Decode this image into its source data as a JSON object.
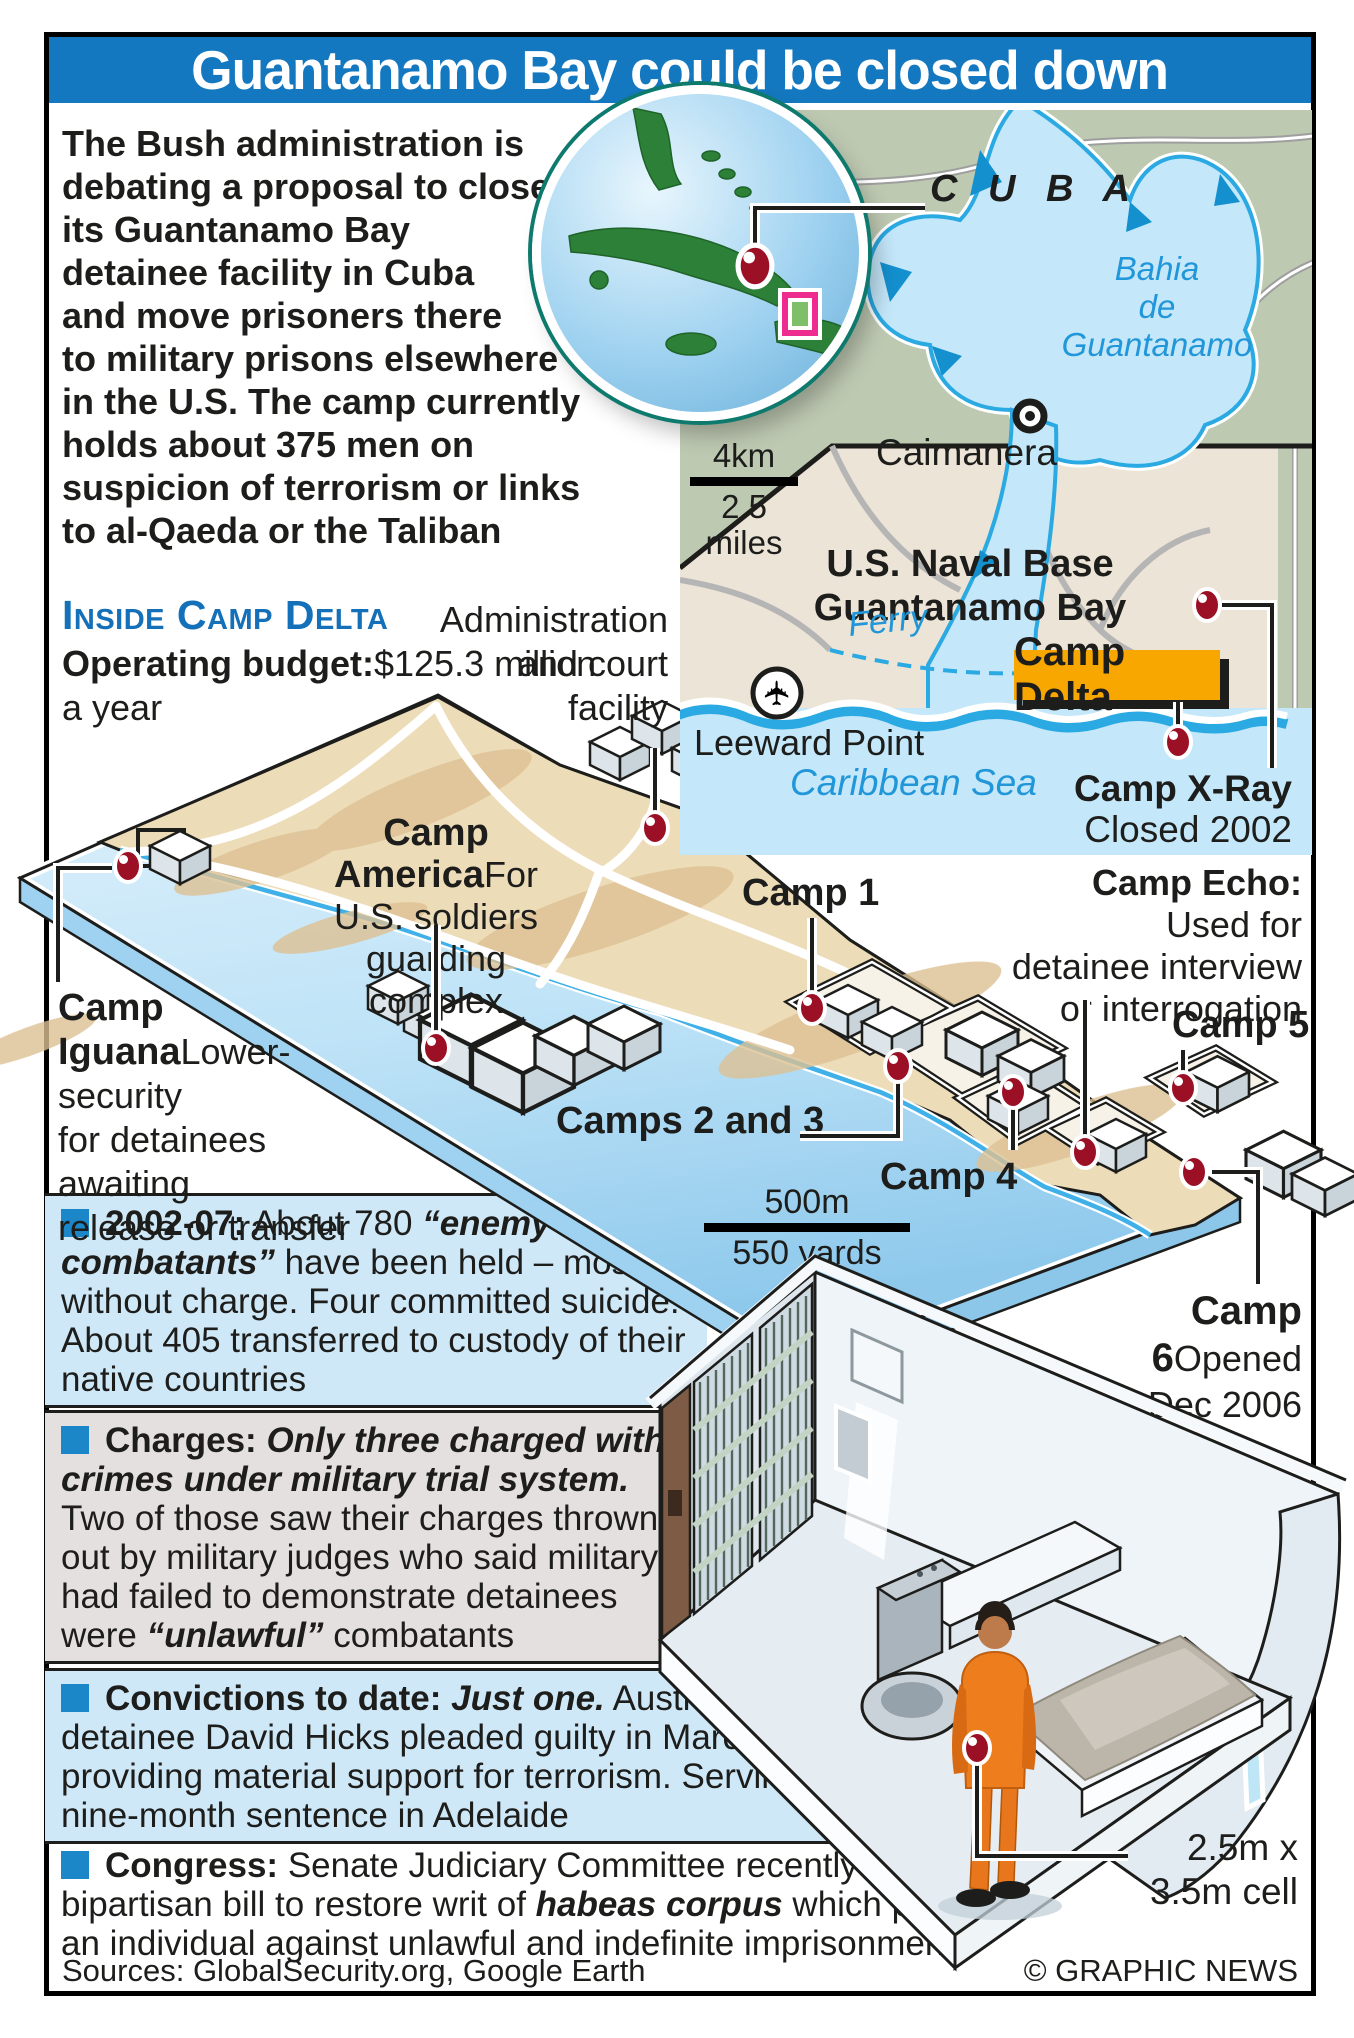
{
  "title": "Guantanamo Bay could be closed down",
  "intro": "The Bush administration is\ndebating a proposal to close\nits Guantanamo Bay\ndetainee facility in Cuba\nand move prisoners there\nto military prisons elsewhere\nin the U.S. The camp currently\nholds about 375 men on\nsuspicion of terrorism or links\nto al-Qaeda or the Taliban",
  "icd": {
    "heading": "Inside Camp Delta",
    "budget_lead": "Operating budget:",
    "budget_rest": "$125.3 million\na year"
  },
  "admin": {
    "label": "Administration\nand court\nfacility"
  },
  "cuba": {
    "cuba": "C U B A",
    "bahia": "Bahia\nde\nGuantanamo",
    "caimanera": "Caimanera",
    "naval": "U.S. Naval Base\nGuantanamo Bay",
    "ferry": "Ferry",
    "delta": "Camp Delta",
    "leeward": "Leeward Point",
    "caribbean": "Caribbean Sea",
    "xray_lead": "Camp X-Ray",
    "xray_rest": "Closed 2002",
    "scale_km": "4km",
    "scale_miles": "2.5 miles"
  },
  "site": {
    "america_lead": "Camp America",
    "america_rest": "For U.S. soldiers\nguarding complex",
    "camp1": "Camp 1",
    "camps23": "Camps 2 and 3",
    "camp4": "Camp 4",
    "echo_lead": "Camp Echo:",
    "echo_rest": " Used for\ndetainee interview\nor interrogation",
    "camp5": "Camp 5",
    "camp6_lead": "Camp 6",
    "camp6_rest": "Opened\nDec 2006",
    "iguana_lead": "Camp\nIguana",
    "iguana_rest": "Lower-security\nfor detainees awaiting\nrelease or transfer",
    "scale_m": "500m",
    "scale_yd": "550 yards"
  },
  "facts": {
    "box1": {
      "lead": "2002-07:",
      "s1": " About 780 ",
      "em1": "“enemy combatants”",
      "s2": " have been held – mostly without charge. Four committed suicide. About 405 transferred to custody of their native countries"
    },
    "box2": {
      "lead": "Charges:",
      "em1": " Only three charged with crimes under military trial system.",
      "s1": " Two of those saw their charges thrown out by military judges who said military had failed to demonstrate detainees were ",
      "em2": "“unlawful”",
      "s2": " combatants"
    },
    "box3": {
      "lead": "Convictions to date:",
      "em1": " Just one.",
      "s1": " Australian detainee David Hicks pleaded guilty in March to providing material support for terrorism. Serving nine-month sentence in Adelaide"
    },
    "box4": {
      "lead": "Congress:",
      "s1": " Senate Judiciary Committee recently backed a bipartisan bill to restore writ of ",
      "em1": "habeas corpus",
      "s2": " which protects an individual against unlawful and indefinite imprisonment"
    }
  },
  "cell": {
    "size": "2.5m x\n3.5m cell"
  },
  "footer": {
    "sources": "Sources: GlobalSecurity.org, Google Earth",
    "credit": "© GRAPHIC NEWS"
  }
}
